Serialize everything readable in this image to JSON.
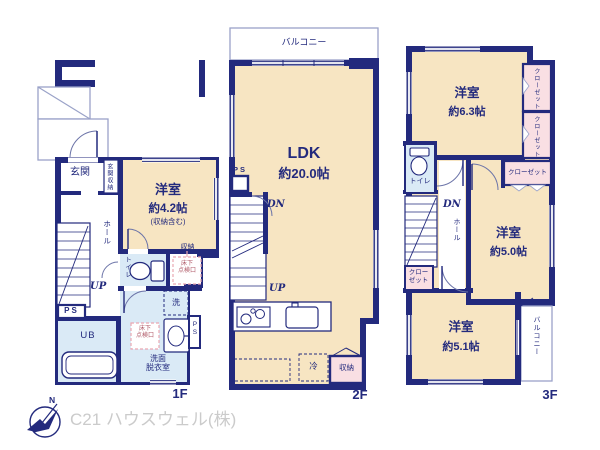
{
  "meta": {
    "floor1_label": "1F",
    "floor2_label": "2F",
    "floor3_label": "3F"
  },
  "colors": {
    "wall_navy": "#232a7d",
    "room_beige": "#f7e5c2",
    "wet_area_blue": "#daeaf6",
    "closet_pink": "#f9dfe3",
    "thin_line": "#9aa2c8",
    "hatch_pink": "#e9a8b2",
    "hatch_text": "#b05a68",
    "credit_gray": "#cbcbcb"
  },
  "f1": {
    "genkan": "玄関",
    "genkan_storage": "玄関収納",
    "room_name": "洋室",
    "room_size": "約4.2帖",
    "room_note": "(収納含む)",
    "hall": "ホール",
    "up": "UP",
    "ps": "PS",
    "toilet": "トイレ",
    "storage": "収納",
    "hatch_l1": "床下",
    "hatch_l2": "点検口",
    "washer": "洗",
    "ub": "UB",
    "washroom_l1": "洗面",
    "washroom_l2": "脱衣室",
    "ps_right": "PS"
  },
  "f2": {
    "balcony": "バルコニー",
    "ldk_name": "LDK",
    "ldk_size": "約20.0帖",
    "ps": "PS",
    "dn": "DN",
    "up": "UP",
    "fridge": "冷",
    "storage": "収納"
  },
  "f3": {
    "room1_name": "洋室",
    "room1_size": "約6.3帖",
    "closet_v1": "クローゼット",
    "closet_v2": "クローゼット",
    "closet_h": "クローゼット",
    "toilet": "トイレ",
    "dn": "DN",
    "hall": "ホール",
    "closet_small": "クローゼット",
    "room2_name": "洋室",
    "room2_size": "約5.0帖",
    "room3_name": "洋室",
    "room3_size": "約5.1帖",
    "balcony": "バルコニー"
  },
  "footer": {
    "compass_n": "N",
    "company": "C21 ハウスウェル(株)"
  }
}
